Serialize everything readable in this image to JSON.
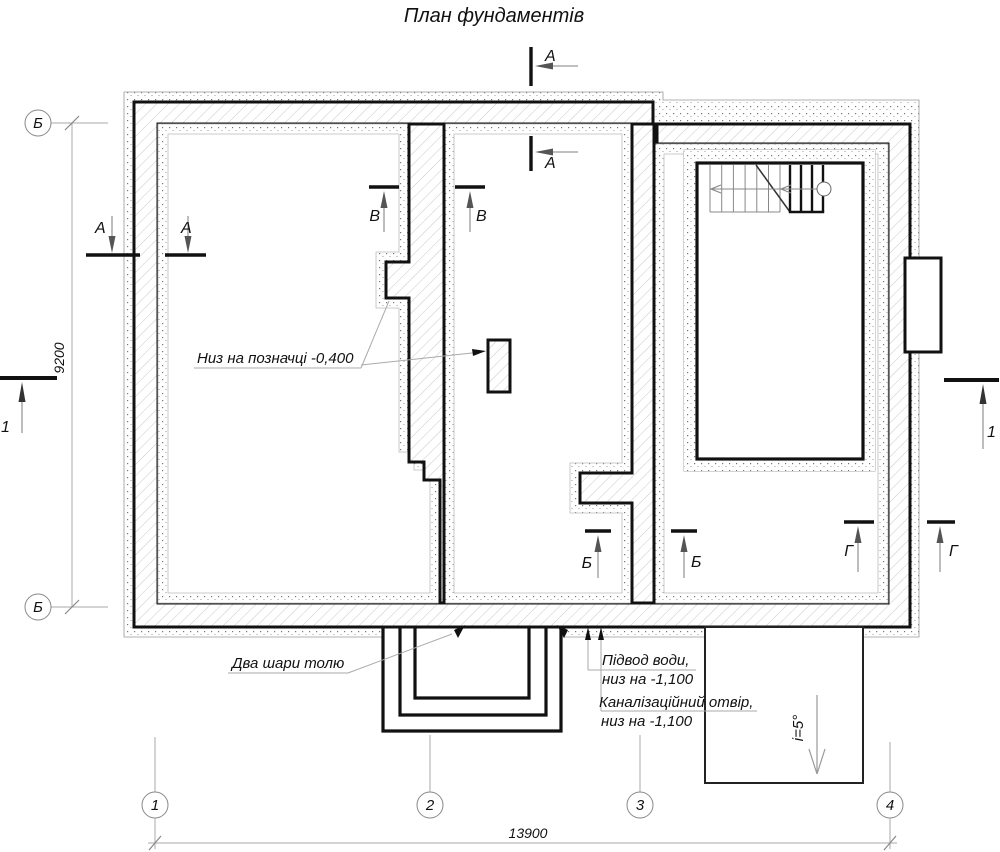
{
  "title": "План фундаментів",
  "grid": {
    "h1": "1",
    "h2": "2",
    "h3": "3",
    "h4": "4",
    "v": "Б"
  },
  "dims": {
    "width": "13900",
    "height": "9200"
  },
  "sections": {
    "a": "А",
    "b": "Б",
    "v": "В",
    "g": "Г",
    "one": "1"
  },
  "annotations": {
    "level_note": "Низ на позначці -0,400",
    "felt_note": "Два шари толю",
    "water_line1": "Підвод води,",
    "water_line2": "низ на -1,100",
    "sewer_line1": "Каналізаційний отвір,",
    "sewer_line2": "низ на -1,100",
    "slope": "і=5°"
  },
  "colors": {
    "line": "#111111",
    "thin": "#999999",
    "hatch": "#c9c9c9"
  }
}
